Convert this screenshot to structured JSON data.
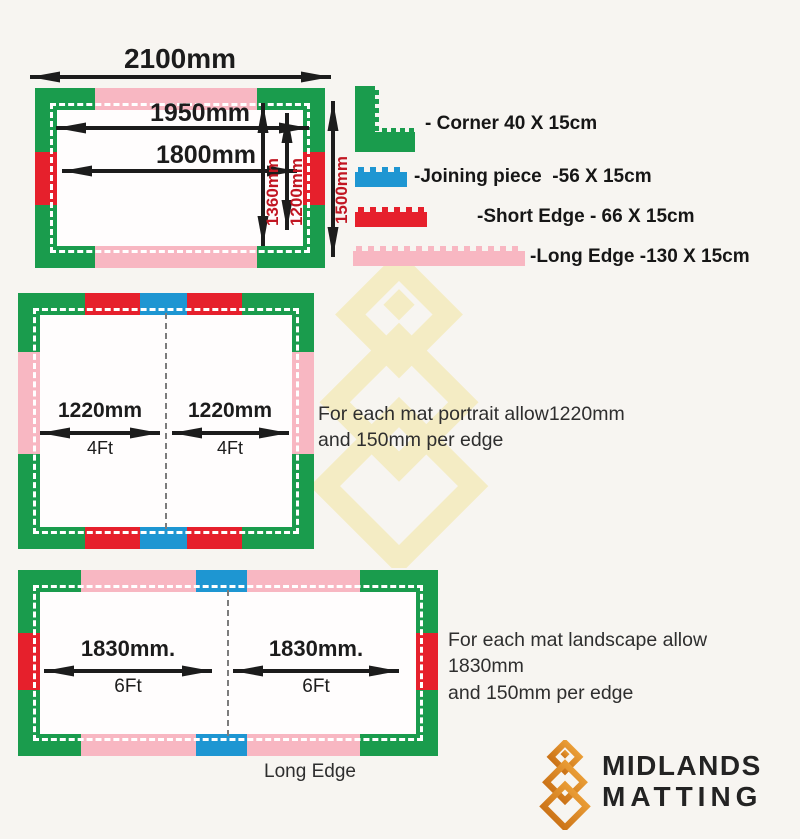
{
  "colors": {
    "corner_green": "#1a9c4d",
    "short_edge_red": "#e6202c",
    "long_edge_pink": "#f8b7c2",
    "joining_blue": "#1e96d2",
    "dimension_red_text": "#c11622",
    "arrow_black": "#1c1c1c",
    "watermark_yellow": "#f3e5a0",
    "logo_orange": "#e0831f"
  },
  "diagram1": {
    "dims": {
      "total_width": "2100mm",
      "inner_width_1": "1950mm",
      "inner_width_2": "1800mm",
      "inner_height_1": "1360mm",
      "inner_height_2": "1200mm",
      "total_height": "1500mm"
    }
  },
  "legend": {
    "items": [
      {
        "name": "corner",
        "label": "- Corner 40 X 15cm"
      },
      {
        "name": "joining-piece",
        "label": "-Joining piece  -56 X 15cm"
      },
      {
        "name": "short-edge",
        "label": "-Short Edge - 66 X 15cm"
      },
      {
        "name": "long-edge",
        "label": "-Long Edge -130 X 15cm"
      }
    ]
  },
  "diagram2": {
    "mats": [
      {
        "dim": "1220mm",
        "ft": "4Ft"
      },
      {
        "dim": "1220mm",
        "ft": "4Ft"
      }
    ],
    "note_line1": "For each mat portrait allow1220mm",
    "note_line2": "and 150mm per edge"
  },
  "diagram3": {
    "mats": [
      {
        "dim": "1830mm.",
        "ft": "6Ft"
      },
      {
        "dim": "1830mm.",
        "ft": "6Ft"
      }
    ],
    "note_line1": "For each mat landscape allow 1830mm",
    "note_line2": "and 150mm per edge",
    "bottom_label": "Long Edge"
  },
  "logo": {
    "line1": "MIDLANDS",
    "line2": "MATTING"
  }
}
